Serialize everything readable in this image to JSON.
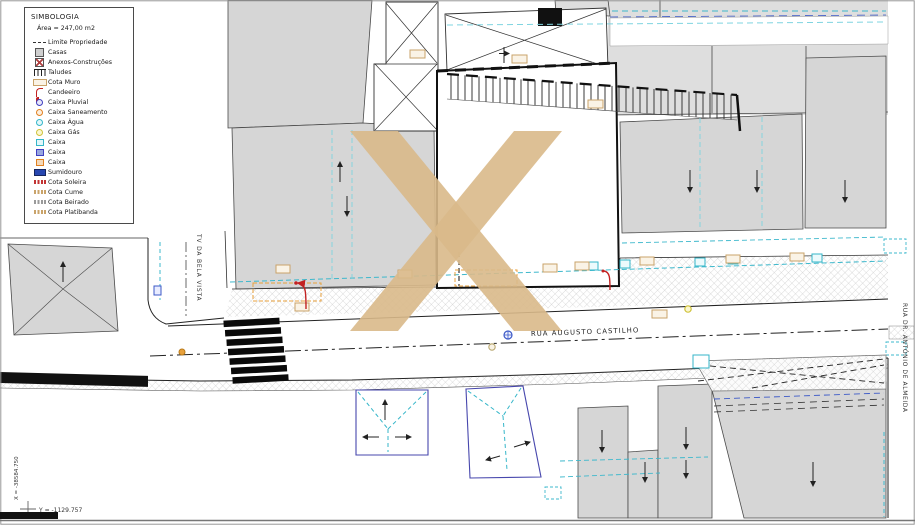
{
  "legend": {
    "title": "SIMBOLOGIA",
    "area": "Área = 247,00 m2",
    "items": [
      {
        "icon": "limite-propriedade-dash-line",
        "label": "Limite Propriedade"
      },
      {
        "icon": "casas-gray-square",
        "label": "Casas"
      },
      {
        "icon": "anexos-x-square",
        "label": "Anexos-Construções"
      },
      {
        "icon": "taludes-comb",
        "label": "Taludes"
      },
      {
        "icon": "cota-muro-tan-box",
        "label": "Cota Muro"
      },
      {
        "icon": "candeeiro-red-lamp",
        "label": "Candeeiro"
      },
      {
        "icon": "caixa-pluvial-blue-circle",
        "label": "Caixa Pluvial"
      },
      {
        "icon": "caixa-saneamento-orange-circle",
        "label": "Caixa Saneamento"
      },
      {
        "icon": "caixa-agua-cyan-circle",
        "label": "Caixa Água"
      },
      {
        "icon": "caixa-gas-yellow-circle",
        "label": "Caixa Gás"
      },
      {
        "icon": "caixa-cyan-square",
        "label": "Caixa"
      },
      {
        "icon": "caixa-blue-square",
        "label": "Caixa"
      },
      {
        "icon": "caixa-orange-square",
        "label": "Caixa"
      },
      {
        "icon": "sumidouro-blue-rect",
        "label": "Sumidouro"
      },
      {
        "icon": "cota-soleira-red-text",
        "label": "Cota Soleira"
      },
      {
        "icon": "cota-cume-tan-text",
        "label": "Cota Cume"
      },
      {
        "icon": "cota-beirado-gray-text",
        "label": "Cota Beirado"
      },
      {
        "icon": "cota-platibanda-tan-text",
        "label": "Cota Platibanda"
      }
    ]
  },
  "streets": {
    "main_road": "RUA AUGUSTO CASTILHO",
    "left_road": "TV DA BELA VISTA",
    "right_road": "RUA DR. ANTÓNIO DE ALMEIDA"
  },
  "coordinates": {
    "x_label": "X = -38584.750",
    "y_label": "Y = -1129.757"
  },
  "watermark": {
    "symbol": "X",
    "color": "#d9b98a"
  },
  "colors": {
    "building_fill": "#d6d6d6",
    "cyan": "#35b6c9",
    "blue": "#3c59c7",
    "orange": "#e8a13c",
    "red": "#c22222",
    "tan": "#c9a36a"
  }
}
